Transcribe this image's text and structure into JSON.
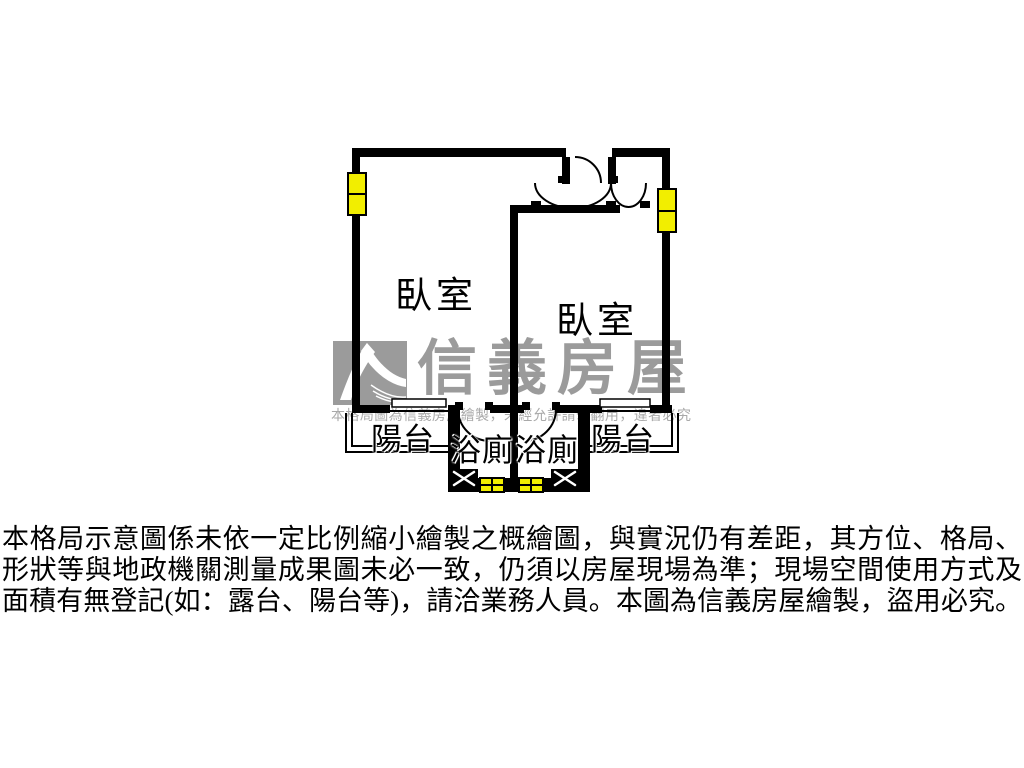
{
  "theme": {
    "wall": "#000000",
    "window_yellow": "#f2ee00",
    "watermark_gray": "#9b9b9b",
    "notice_gray": "#a9a9a9",
    "label_color": "#000000"
  },
  "watermark": {
    "brand_name": "信義房屋",
    "notice": "本格局圖為信義房屋繪製，未經允許請勿翻用，違者必究"
  },
  "floor_plan": {
    "rooms": [
      {
        "id": "bedroom-left",
        "label": "臥室"
      },
      {
        "id": "bedroom-right",
        "label": "臥室"
      },
      {
        "id": "balcony-left",
        "label": "陽台"
      },
      {
        "id": "bathroom-left",
        "label": "浴廁"
      },
      {
        "id": "bathroom-right",
        "label": "浴廁"
      },
      {
        "id": "balcony-right",
        "label": "陽台"
      }
    ]
  },
  "disclaimer": {
    "lines": [
      "本格局示意圖係未依一定比例縮小繪製之概繪圖，與實況仍有差距，其方位、格局、",
      "形狀等與地政機關測量成果圖未必一致，仍須以房屋現場為準；現場空間使用方式及",
      "面積有無登記(如：露台、陽台等)，請洽業務人員。本圖為信義房屋繪製，盜用必究。"
    ]
  }
}
